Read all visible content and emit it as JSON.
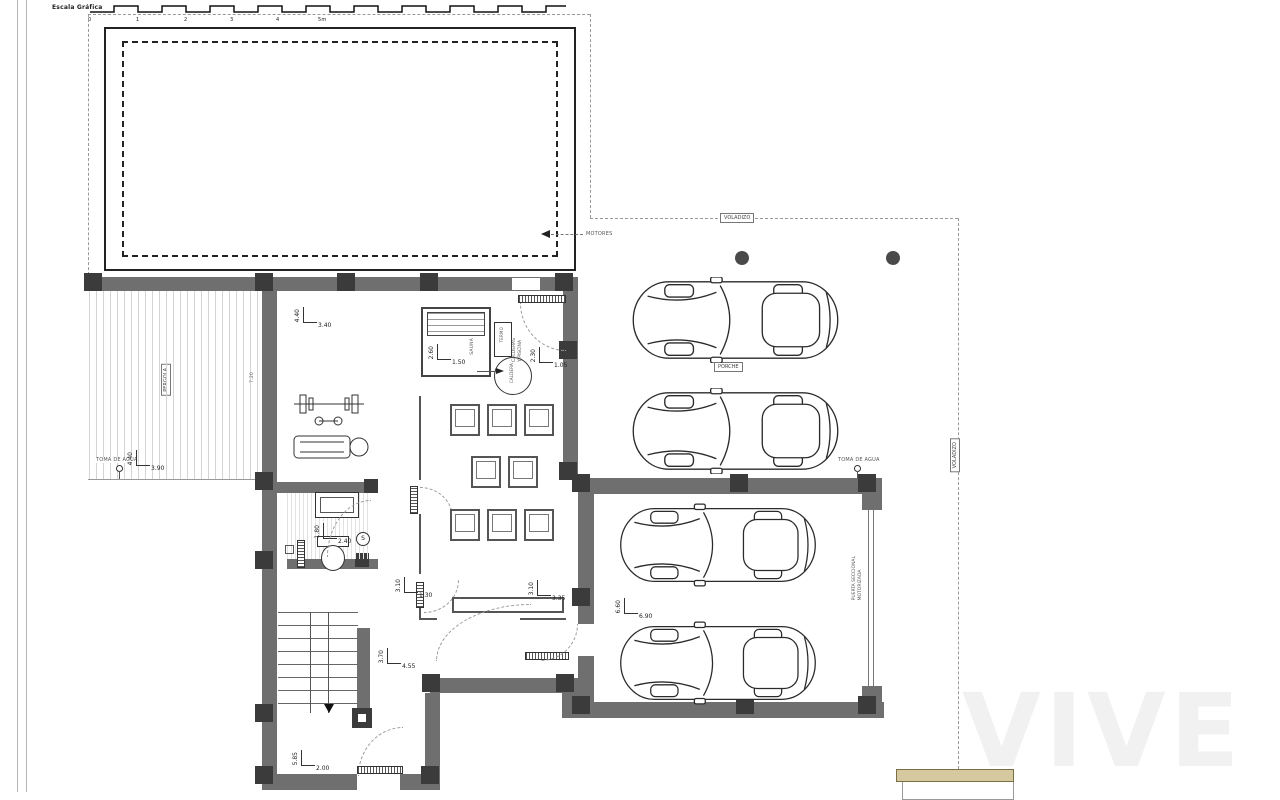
{
  "colors": {
    "wall": "#6f6f6f",
    "column": "#3b3b3b",
    "line": "#222222",
    "dashed_boundary": "#999999",
    "terrace_hatch": "#d4d4d4",
    "steps_tan": "#d6c9a0"
  },
  "scale_bar": {
    "label": "Escala Gráfica",
    "ticks": [
      "0",
      "1",
      "2",
      "3",
      "4",
      "5m"
    ]
  },
  "annotations": {
    "motores": "MOTORES",
    "voladizo_top": "VOLADIZO",
    "voladizo_right": "VOLADIZO",
    "pergola": "PERGOLA",
    "toma_de_agua_left": "TOMA DE AGUA",
    "toma_de_agua_right": "TOMA DE AGUA",
    "porche": "PORCHE",
    "sauna": "SAUNA",
    "termo": "TERMO",
    "caldera": "CALDERA",
    "caldera_line1": "CALDERAS",
    "caldera_line2": "Y PISCINA",
    "puerta_line1": "PUERTA SECCIONAL",
    "puerta_line2": "MOTORIZADA",
    "s_marker": "S",
    "nivel": "7.20"
  },
  "dimensions": {
    "terrace": {
      "v": "4.40",
      "h": "3.90"
    },
    "gym": {
      "v": "4.40",
      "h": "3.40"
    },
    "sauna": {
      "v": "2.60",
      "h": "1.50"
    },
    "boiler": {
      "v": "2.30",
      "h": "1.05"
    },
    "lounge_door": {
      "v": "3.10",
      "h": "1.30"
    },
    "lounge": {
      "v": "3.10",
      "h": "3.35"
    },
    "bath": {
      "v": "1.80",
      "h": "2.40"
    },
    "stairs": {
      "v": "3.70",
      "h": "4.55"
    },
    "store": {
      "v": "5.85",
      "h": "2.00"
    },
    "garage": {
      "v": "6.60",
      "h": "6.90"
    }
  },
  "watermark": "VIVE"
}
